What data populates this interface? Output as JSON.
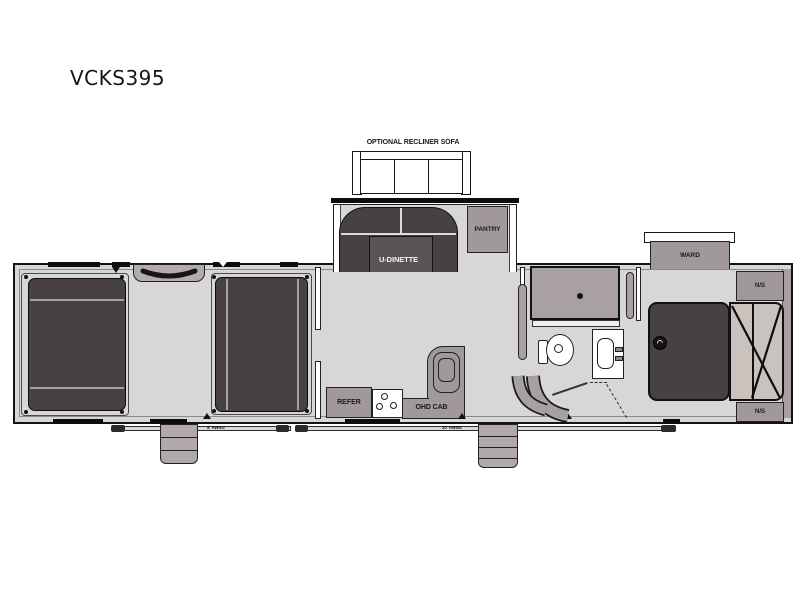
{
  "title": "VCKS395",
  "floorplan": {
    "optional_sofa_label": "OPTIONAL RECLINER SOFA",
    "dinette_label": "U-DINETTE",
    "pantry_label": "PANTRY",
    "ward_label": "WARD",
    "nightstand_top_label": "N/S",
    "nightstand_bottom_label": "N/S",
    "refer_label": "REFER",
    "ohd_cab_label": "OHD CAB",
    "awning_left_label": "8' AWNG",
    "awning_right_label": "20' AWNG"
  },
  "colors": {
    "dark_furniture": "#474143",
    "medium_gray": "#a09899",
    "floor_gray": "#d8d7d8",
    "mattress_tan": "#c9c2bd",
    "outline": "#131313"
  }
}
